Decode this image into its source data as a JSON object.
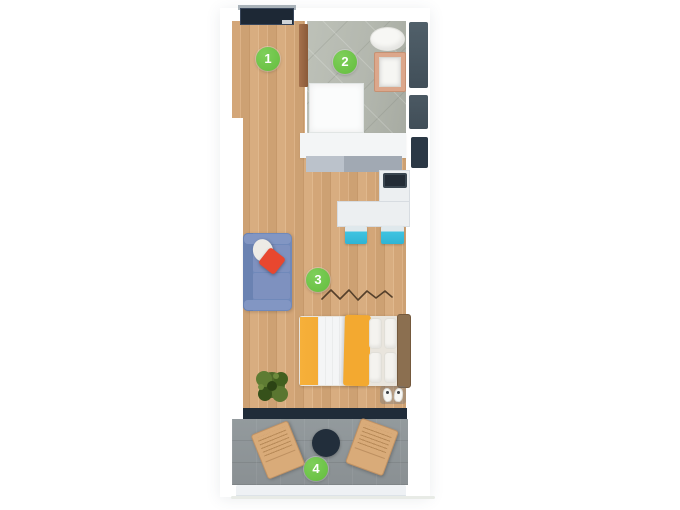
{
  "floorplan": {
    "title": "studio-apartment-floor-plan",
    "marker_color": "#6cc24a",
    "markers": [
      {
        "label": "1",
        "room": "entrance-hall"
      },
      {
        "label": "2",
        "room": "bathroom"
      },
      {
        "label": "3",
        "room": "living-sleeping-area"
      },
      {
        "label": "4",
        "room": "balcony"
      }
    ],
    "furniture": [
      "entrance-door",
      "bathroom-door",
      "toilet",
      "vanity-sink",
      "shower",
      "kitchen-counter",
      "desk",
      "monitor",
      "desk-chair",
      "desk-chair",
      "sofa",
      "round-pillow",
      "red-pillow",
      "bed",
      "headboard",
      "bed-pillows",
      "plant",
      "slippers",
      "balcony-table",
      "balcony-chair",
      "balcony-chair"
    ],
    "colors": {
      "wood_floor": "#d3a678",
      "bathroom_floor": "#b4b8af",
      "balcony_floor": "#8e9497",
      "wall_dark": "#202c39",
      "sofa": "#7089ba",
      "bed_accent": "#f3a930",
      "desk_chair_accent": "#3fc3e1",
      "pillow_red": "#e8472f",
      "marker_green": "#6cc24a"
    }
  }
}
